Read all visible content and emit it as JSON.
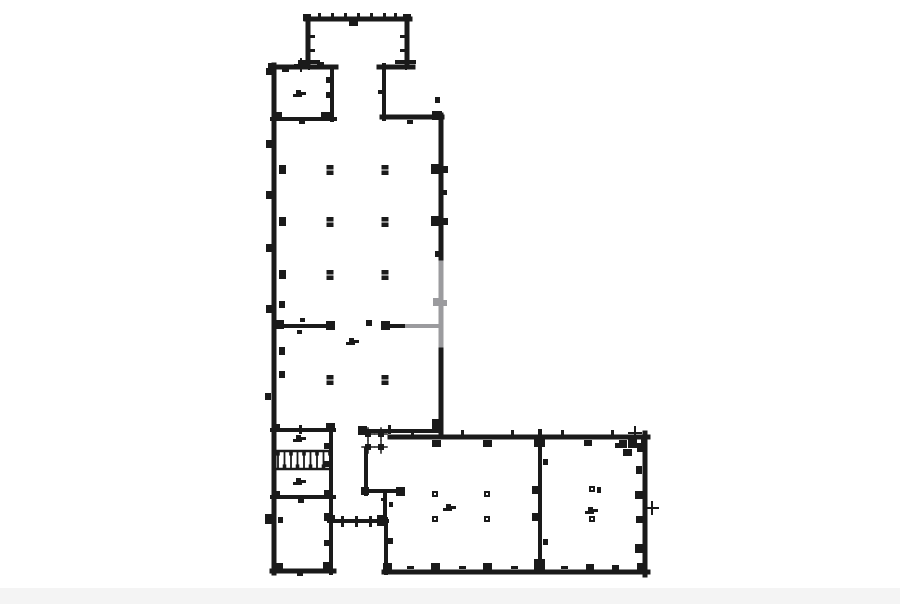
{
  "page": {
    "background": "#ffffff"
  },
  "diagram": {
    "type": "architectural-floor-plan",
    "canvas": {
      "width": 900,
      "height": 604
    },
    "colors": {
      "ink": "#1a1a1a",
      "faded": "#9b9b9e",
      "paper": "#ffffff",
      "noise_band": "#f4f4f4"
    },
    "walls": [
      [
        306,
        19,
        410,
        19,
        5
      ],
      [
        308,
        17,
        308,
        64,
        5
      ],
      [
        407,
        17,
        407,
        64,
        5
      ],
      [
        300,
        62,
        318,
        62,
        4
      ],
      [
        397,
        62,
        414,
        62,
        4
      ],
      [
        272,
        67,
        336,
        67,
        5
      ],
      [
        379,
        67,
        413,
        67,
        5
      ],
      [
        384,
        65,
        384,
        119,
        4
      ],
      [
        382,
        117,
        442,
        117,
        5
      ],
      [
        441,
        115,
        441,
        267,
        5
      ],
      [
        441,
        341,
        441,
        434,
        5
      ],
      [
        274,
        65,
        274,
        573,
        5
      ],
      [
        332,
        67,
        332,
        120,
        4
      ],
      [
        272,
        119,
        335,
        119,
        4
      ],
      [
        276,
        326,
        331,
        326,
        4
      ],
      [
        386,
        326,
        409,
        326,
        4
      ],
      [
        272,
        430,
        334,
        430,
        4
      ],
      [
        331,
        428,
        331,
        499,
        4
      ],
      [
        275,
        451,
        330,
        451,
        2.5
      ],
      [
        275,
        469,
        330,
        469,
        2.5
      ],
      [
        272,
        497,
        334,
        497,
        4
      ],
      [
        331,
        497,
        331,
        573,
        4
      ],
      [
        272,
        571,
        334,
        571,
        5
      ],
      [
        333,
        521,
        387,
        521,
        4
      ],
      [
        386,
        519,
        386,
        573,
        4
      ],
      [
        366,
        449,
        366,
        494,
        4
      ],
      [
        364,
        491,
        402,
        491,
        4
      ],
      [
        385,
        491,
        385,
        523,
        4
      ],
      [
        360,
        431,
        441,
        431,
        4
      ],
      [
        390,
        437,
        648,
        437,
        5
      ],
      [
        645,
        433,
        645,
        575,
        5
      ],
      [
        384,
        572,
        648,
        572,
        5
      ],
      [
        540,
        437,
        540,
        572,
        4
      ]
    ],
    "faded_walls": [
      [
        441,
        263,
        441,
        345,
        5
      ],
      [
        407,
        326,
        438,
        326,
        4
      ]
    ],
    "marks": [
      [
        318,
        13,
        3,
        5
      ],
      [
        331,
        13,
        3,
        5
      ],
      [
        344,
        13,
        3,
        5
      ],
      [
        357,
        13,
        3,
        5
      ],
      [
        370,
        13,
        3,
        5
      ],
      [
        383,
        13,
        3,
        5
      ],
      [
        394,
        13,
        3,
        5
      ],
      [
        349,
        21,
        9,
        5
      ],
      [
        303,
        14,
        8,
        7
      ],
      [
        403,
        14,
        8,
        7
      ],
      [
        310,
        35,
        5,
        3
      ],
      [
        400,
        35,
        5,
        3
      ],
      [
        310,
        49,
        5,
        3
      ],
      [
        400,
        49,
        5,
        3
      ],
      [
        282,
        68,
        7,
        4
      ],
      [
        317,
        62,
        7,
        6
      ],
      [
        268,
        63,
        8,
        8
      ],
      [
        326,
        77,
        6,
        6
      ],
      [
        326,
        92,
        6,
        6
      ],
      [
        276,
        112,
        6,
        6
      ],
      [
        321,
        112,
        9,
        8
      ],
      [
        299,
        120,
        6,
        4
      ],
      [
        266,
        68,
        6,
        7
      ],
      [
        378,
        90,
        5,
        4
      ],
      [
        407,
        120,
        6,
        4
      ],
      [
        432,
        111,
        10,
        9
      ],
      [
        431,
        164,
        10,
        10
      ],
      [
        443,
        166,
        5,
        7
      ],
      [
        431,
        216,
        10,
        10
      ],
      [
        443,
        218,
        5,
        7
      ],
      [
        435,
        97,
        5,
        6
      ],
      [
        435,
        251,
        5,
        6
      ],
      [
        443,
        190,
        4,
        5
      ],
      [
        432,
        419,
        11,
        11
      ],
      [
        279,
        165,
        7,
        9
      ],
      [
        279,
        217,
        7,
        9
      ],
      [
        279,
        270,
        7,
        9
      ],
      [
        279,
        301,
        6,
        7
      ],
      [
        279,
        347,
        6,
        8
      ],
      [
        279,
        371,
        6,
        7
      ],
      [
        266,
        140,
        6,
        8
      ],
      [
        266,
        191,
        6,
        8
      ],
      [
        266,
        244,
        6,
        8
      ],
      [
        266,
        305,
        6,
        8
      ],
      [
        265,
        393,
        6,
        7
      ],
      [
        275,
        320,
        9,
        9
      ],
      [
        326,
        321,
        9,
        9
      ],
      [
        300,
        318,
        5,
        4
      ],
      [
        297,
        330,
        5,
        4
      ],
      [
        381,
        321,
        9,
        9
      ],
      [
        366,
        320,
        6,
        6
      ],
      [
        272,
        424,
        8,
        7
      ],
      [
        326,
        423,
        9,
        8
      ],
      [
        299,
        425,
        3,
        9
      ],
      [
        358,
        426,
        9,
        9
      ],
      [
        388,
        425,
        3,
        9
      ],
      [
        324,
        443,
        7,
        6
      ],
      [
        324,
        461,
        7,
        6
      ],
      [
        272,
        491,
        8,
        7
      ],
      [
        324,
        490,
        8,
        8
      ],
      [
        298,
        499,
        6,
        4
      ],
      [
        265,
        514,
        7,
        10
      ],
      [
        278,
        517,
        5,
        6
      ],
      [
        324,
        513,
        8,
        8
      ],
      [
        324,
        540,
        7,
        6
      ],
      [
        275,
        563,
        8,
        8
      ],
      [
        323,
        562,
        9,
        9
      ],
      [
        297,
        573,
        6,
        3
      ],
      [
        341,
        516,
        3,
        11
      ],
      [
        355,
        516,
        3,
        11
      ],
      [
        369,
        516,
        3,
        11
      ],
      [
        377,
        515,
        10,
        11
      ],
      [
        327,
        515,
        8,
        8
      ],
      [
        396,
        487,
        9,
        9
      ],
      [
        381,
        498,
        5,
        3
      ],
      [
        389,
        502,
        4,
        5
      ],
      [
        361,
        487,
        8,
        8
      ],
      [
        411,
        430,
        3,
        6
      ],
      [
        461,
        430,
        3,
        6
      ],
      [
        511,
        430,
        3,
        6
      ],
      [
        561,
        430,
        3,
        6
      ],
      [
        611,
        430,
        3,
        6
      ],
      [
        432,
        440,
        9,
        7
      ],
      [
        483,
        440,
        9,
        7
      ],
      [
        584,
        440,
        8,
        6
      ],
      [
        534,
        438,
        11,
        9
      ],
      [
        538,
        429,
        4,
        7
      ],
      [
        619,
        440,
        8,
        8
      ],
      [
        628,
        437,
        9,
        11
      ],
      [
        637,
        443,
        8,
        9
      ],
      [
        623,
        449,
        9,
        7
      ],
      [
        641,
        438,
        6,
        6
      ],
      [
        615,
        443,
        5,
        5
      ],
      [
        636,
        466,
        6,
        8
      ],
      [
        635,
        491,
        8,
        8
      ],
      [
        636,
        516,
        7,
        7
      ],
      [
        635,
        544,
        8,
        9
      ],
      [
        637,
        563,
        10,
        10
      ],
      [
        431,
        563,
        9,
        8
      ],
      [
        483,
        563,
        9,
        8
      ],
      [
        586,
        564,
        8,
        7
      ],
      [
        612,
        565,
        7,
        6
      ],
      [
        383,
        563,
        9,
        9
      ],
      [
        407,
        566,
        7,
        3
      ],
      [
        459,
        566,
        7,
        3
      ],
      [
        511,
        566,
        7,
        3
      ],
      [
        561,
        566,
        7,
        3
      ],
      [
        532,
        486,
        7,
        8
      ],
      [
        532,
        513,
        7,
        8
      ],
      [
        543,
        459,
        5,
        6
      ],
      [
        543,
        539,
        5,
        6
      ],
      [
        534,
        559,
        11,
        11
      ],
      [
        388,
        538,
        5,
        6
      ],
      [
        597,
        487,
        4,
        6
      ]
    ],
    "faded_marks": [
      [
        433,
        298,
        8,
        8
      ],
      [
        443,
        300,
        4,
        6
      ]
    ],
    "hall_columns": [
      [
        330,
        170
      ],
      [
        385,
        170
      ],
      [
        330,
        222
      ],
      [
        385,
        222
      ],
      [
        330,
        275
      ],
      [
        385,
        275
      ],
      [
        330,
        380
      ],
      [
        385,
        380
      ]
    ],
    "small_columns": [
      [
        435,
        494
      ],
      [
        487,
        494
      ],
      [
        435,
        519
      ],
      [
        487,
        519
      ],
      [
        592,
        489
      ],
      [
        592,
        519
      ]
    ],
    "cross_columns": [
      [
        368,
        434
      ],
      [
        381,
        434
      ],
      [
        368,
        447
      ],
      [
        381,
        447
      ]
    ],
    "cross_ticks": [
      [
        309,
        63
      ],
      [
        406,
        63
      ],
      [
        301,
        65
      ],
      [
        635,
        433
      ],
      [
        652,
        508
      ]
    ],
    "tags": [
      [
        299,
        93
      ],
      [
        352,
        341
      ],
      [
        299,
        438
      ],
      [
        299,
        481
      ],
      [
        449,
        507
      ],
      [
        591,
        510
      ]
    ],
    "stair": {
      "x": 278,
      "y": 452,
      "width": 52,
      "height": 16,
      "treads": 8
    }
  }
}
